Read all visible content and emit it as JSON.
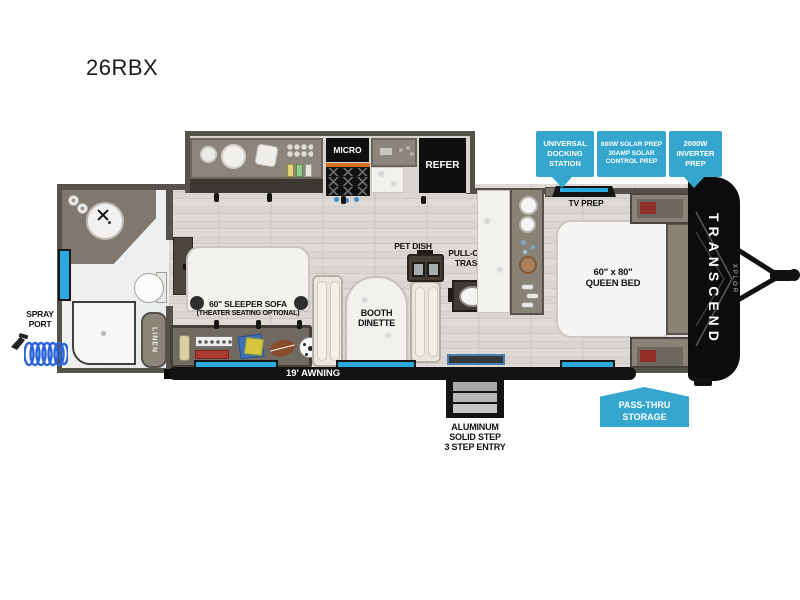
{
  "title": "26RBX",
  "colors": {
    "callout_blue": "#35a7cf",
    "window_blue": "#29abe2",
    "wall_gray": "#55514b",
    "cabinet_taupe": "#8a8177",
    "appliance_black": "#0f0f0f",
    "hose_blue": "#2b63d9"
  },
  "callouts": {
    "docking": "UNIVERSAL\nDOCKING\nSTATION",
    "solar": "600W SOLAR PREP\n30AMP SOLAR\nCONTROL PREP",
    "inverter": "2000W\nINVERTER\nPREP",
    "pass_thru": "PASS-THRU\nSTORAGE"
  },
  "labels": {
    "micro": "MICRO",
    "refer": "REFER",
    "tv_prep": "TV PREP",
    "pet_dish": "PET DISH",
    "pull_out_trash": "PULL-OUT\nTRASH",
    "booth_dinette": "BOOTH\nDINETTE",
    "sleeper_sofa": "60\" SLEEPER SOFA",
    "sleeper_sofa_option": "(THEATER SEATING OPTIONAL)",
    "queen_bed": "60\" x 80\"\nQUEEN BED",
    "spray_port": "SPRAY\nPORT",
    "linen": "LINEN",
    "awning": "19' AWNING",
    "entry_steps": "ALUMINUM\nSOLID STEP\n3 STEP ENTRY"
  },
  "brand": {
    "name": "TRANSCEND",
    "series": "XPLOR"
  },
  "icons": {
    "sink": "double-round-sink",
    "stove": "3x3-burner-grid",
    "tv": "flat-tv-top-view",
    "spray_port": "spray-nozzle-with-coiled-hose",
    "storage_toys": [
      "bottle",
      "game-box",
      "cards",
      "football",
      "soccer-ball"
    ]
  }
}
